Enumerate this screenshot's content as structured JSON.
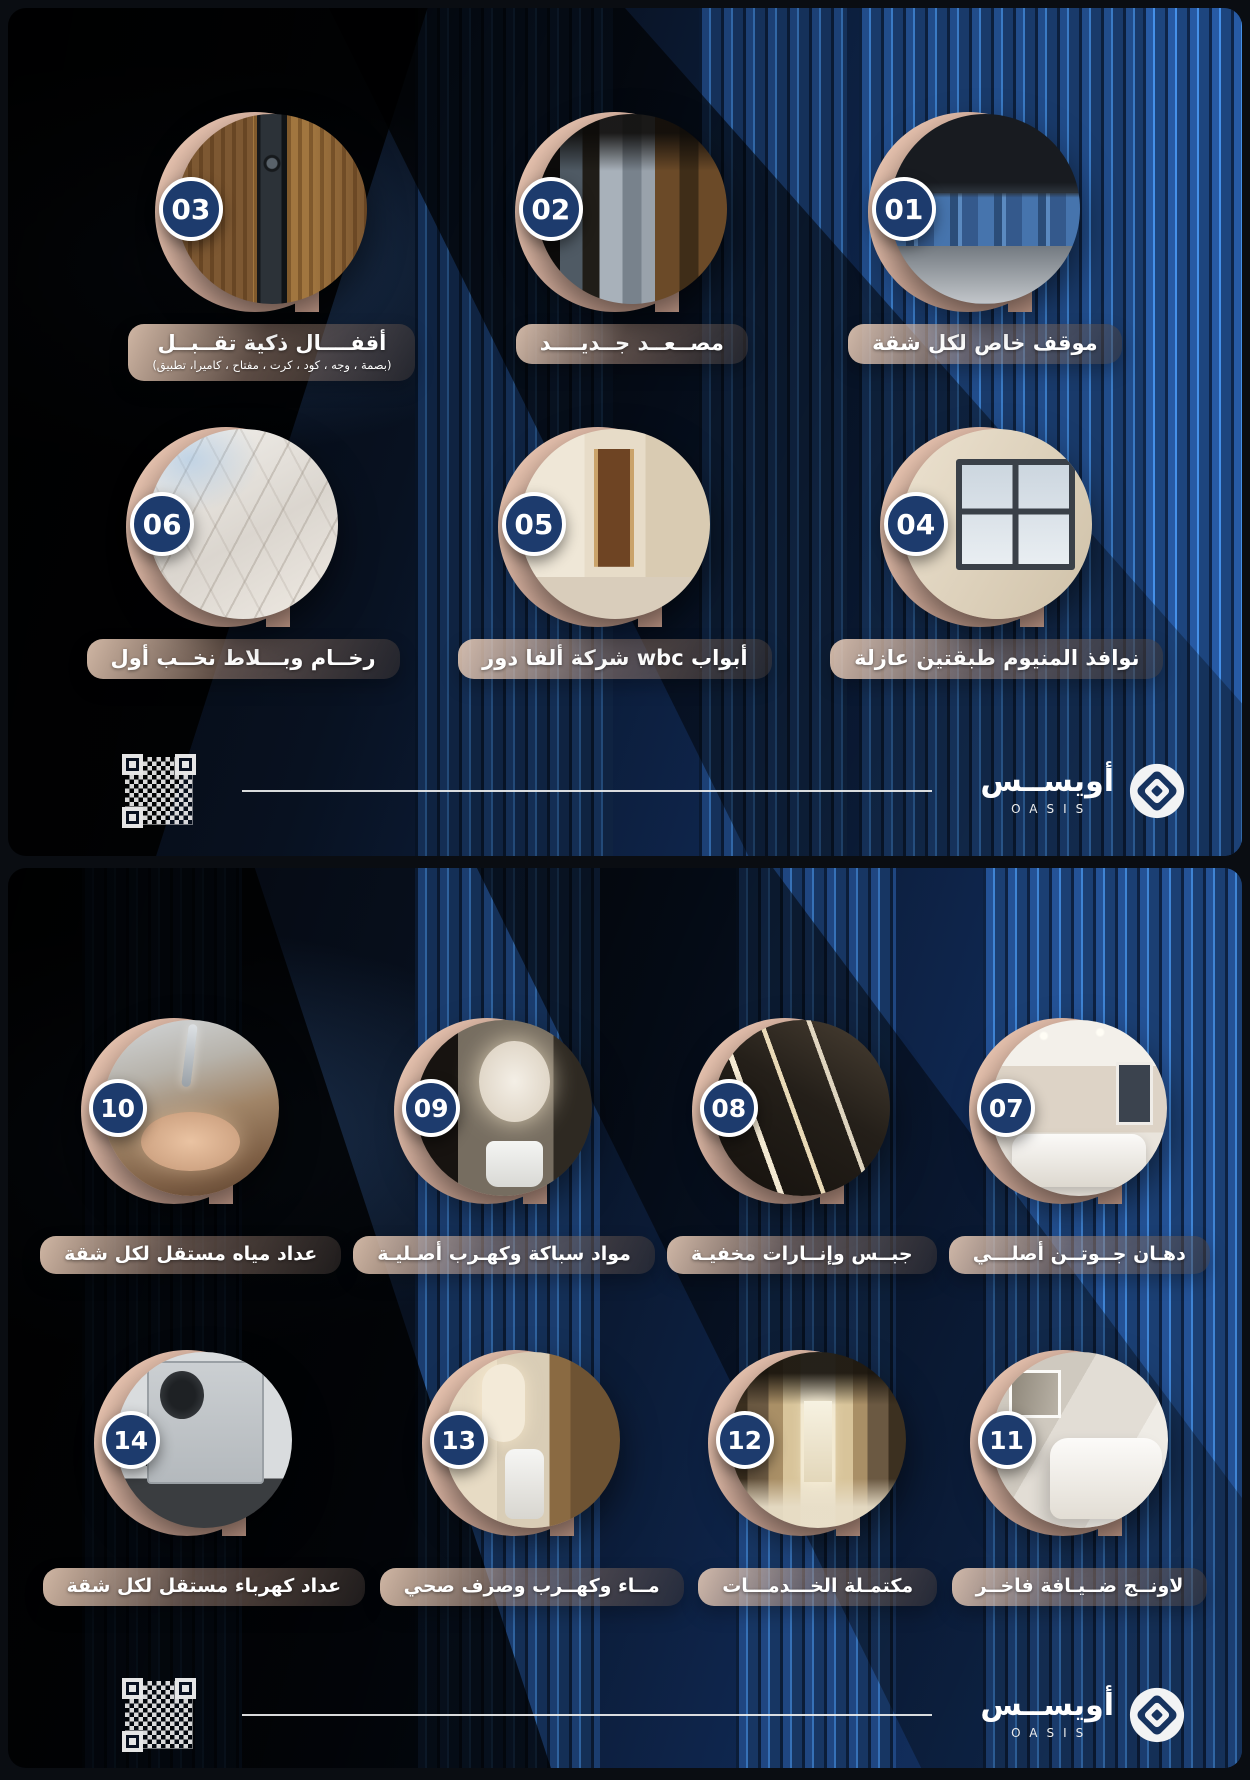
{
  "brand": {
    "name_ar": "أويســس",
    "name_en": "OASIS"
  },
  "colors": {
    "background_navy": "#122b52",
    "building_fin_blue": "#1c4075",
    "badge_navy": "#1d3b6d",
    "crescent_beige": "#dcb4a2",
    "pill_beige": "#e0c0a6",
    "text_white": "#ffffff"
  },
  "icons": {
    "logo_mark": "diamond-in-circle-icon",
    "qr": "qr-code"
  },
  "panels": [
    {
      "rows": [
        [
          {
            "number": "03",
            "label": "أقفــــال ذكية تقــبــل",
            "sublabel": "(بصمة ، وجه ، كود ، كرت ، مفتاح ، كاميرا، تطبيق)",
            "photo": "lock"
          },
          {
            "number": "02",
            "label": "مصــعــد جــديــــد",
            "photo": "elevator"
          },
          {
            "number": "01",
            "label": "موقف خاص لكل شقة",
            "photo": "parking"
          }
        ],
        [
          {
            "number": "06",
            "label": "رخــام وبـــلاط نخــب أول",
            "photo": "marble"
          },
          {
            "number": "05",
            "label": "أبواب wbc شركة ألفا دور",
            "photo": "door"
          },
          {
            "number": "04",
            "label": "نوافذ المنيوم طبقتين عازلة",
            "photo": "window"
          }
        ]
      ]
    },
    {
      "rows": [
        [
          {
            "number": "10",
            "label": "عداد مياه مستقل لكل شقة",
            "photo": "handwash"
          },
          {
            "number": "09",
            "label": "مواد سباكة وكهـرب أصـليـة",
            "photo": "mirror"
          },
          {
            "number": "08",
            "label": "جبــس وإنــارات مخفيـة",
            "photo": "gypsum"
          },
          {
            "number": "07",
            "label": "دهـان جــوتــن أصلـــي",
            "photo": "livingroom"
          }
        ],
        [
          {
            "number": "14",
            "label": "عداد كهرباء مستقل لكل شقة",
            "photo": "emeter"
          },
          {
            "number": "13",
            "label": "مــاء وكهــرب وصرف صحي",
            "photo": "bathroom"
          },
          {
            "number": "12",
            "label": "مكتمـلة الخـــدمـــات",
            "photo": "hallway"
          },
          {
            "number": "11",
            "label": "لاونــج ضــيـافة فاخــر",
            "photo": "lounge"
          }
        ]
      ]
    }
  ]
}
